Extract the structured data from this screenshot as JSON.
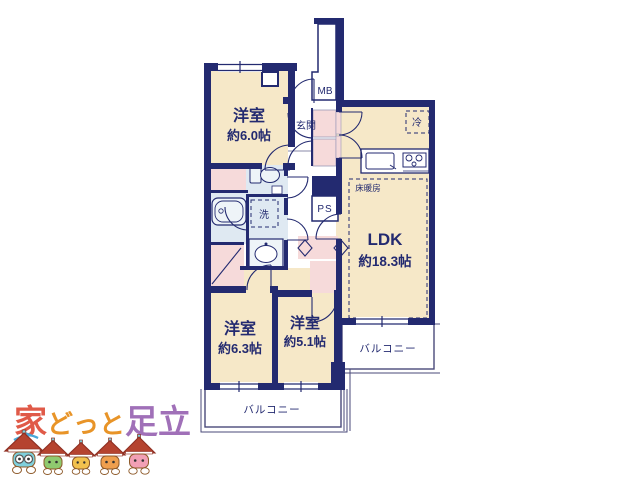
{
  "plan": {
    "rooms": {
      "bedroom_top": {
        "label": "洋室",
        "size": "約6.0帖"
      },
      "bedroom_left": {
        "label": "洋室",
        "size": "約6.3帖"
      },
      "bedroom_mid": {
        "label": "洋室",
        "size": "約5.1帖"
      },
      "ldk": {
        "label": "LDK",
        "size": "約18.3帖"
      }
    },
    "labels": {
      "entrance": "玄関",
      "meter_box": "MB",
      "pipe_space": "PS",
      "fridge": "冷",
      "floor_heating": "床暖房",
      "washer": "洗"
    },
    "balconies": {
      "right_label": "バルコニー",
      "bottom_label": "バルコニー"
    },
    "colors": {
      "wall": "#232a70",
      "room_fill": "#f6e8c8",
      "closet_fill": "#f6dada",
      "wet_fill": "#dfe9f2",
      "fixture_fill": "#eef4f8",
      "balcony_line": "#4a4a7a"
    }
  },
  "logo": {
    "parts": [
      {
        "text": "家",
        "color": "#e05a48"
      },
      {
        "text": "どっと",
        "color": "#e89428"
      },
      {
        "text": "足立",
        "color": "#a070b8"
      }
    ],
    "mascots": [
      {
        "name": "mascot-teal",
        "color": "#7fd0dc"
      },
      {
        "name": "mascot-green",
        "color": "#8fca6f"
      },
      {
        "name": "mascot-yellow",
        "color": "#f2c14e"
      },
      {
        "name": "mascot-orange",
        "color": "#ef9f4e"
      },
      {
        "name": "mascot-pink",
        "color": "#f2a0b5"
      }
    ],
    "roof_color": "#b5432f",
    "swirl_color": "#4aa8d8"
  }
}
